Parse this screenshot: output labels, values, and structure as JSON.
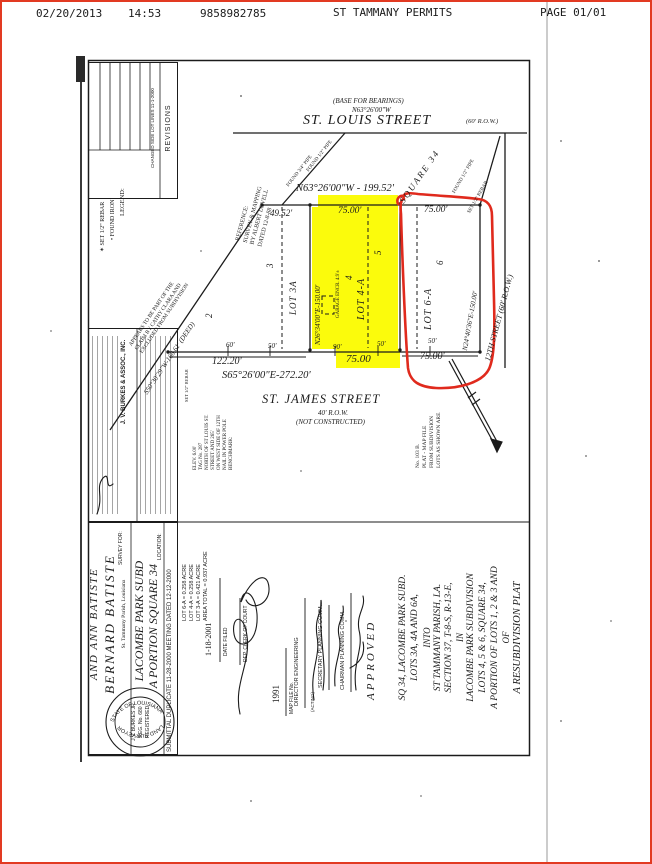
{
  "colors": {
    "highlight": "#fbfb0c",
    "annotation_red": "#e02a1d",
    "ink": "#1b1b1b",
    "page_border": "#e23a22"
  },
  "fax_header": {
    "date": "02/20/2013",
    "time": "14:53",
    "fax_number": "9858982785",
    "sender": "ST TAMMANY PERMITS",
    "page": "PAGE  01/01"
  },
  "revisions": {
    "title": "REVISIONS",
    "entry": "CHANGED SIDE LOT LINES 11-1-2000"
  },
  "legend": {
    "title": "LEGEND:",
    "item_found": "• FOUND IRON",
    "item_set": "✶ SET 1/2\" REBAR"
  },
  "firm": {
    "name": "J. V. BURKES & ASSOC., INC."
  },
  "map": {
    "bearing_note": "(BASE FOR BEARINGS)",
    "bearing_value": "N63°26'00\"W",
    "st_louis": "ST. LOUIS STREET",
    "st_louis_row": "(60' R.O.W.)",
    "square": "SQUARE 34",
    "north_line": "N63°26'00\"W - 199.52'",
    "reference": [
      "REFERENCE:",
      "SURVEY & MAPPING",
      "BY ALBERT LOVELL",
      "DATED 12-8-88"
    ],
    "claim": [
      "APPEARS TO BE PART OF THE",
      "CLAIM BY CATHY CLARA AND",
      "EXCLUDED FROM SUBDIVISION"
    ],
    "deed_line": "S50°30'29\"W-166.61' (DEED)",
    "monuments": {
      "m1": "FOUND 3/4\" PIPE",
      "m2": "FOUND 1/2\" PIPE",
      "m3": "FOUND 1/2\" PIPE",
      "m4": "SET 1/2\" REBAR",
      "m5": "SET 1/2\" REBAR"
    },
    "lots": {
      "lot3a": {
        "name": "LOT 3A",
        "old_a": "2",
        "old_b": "3",
        "top": "49.52'"
      },
      "lot4a": {
        "name": "LOT 4-A",
        "old_a": "4",
        "old_b": "5",
        "top": "75.00'",
        "bottom": "75.00",
        "west": "N26°34'00\"E-150.00'",
        "garage": "GARAGE ENCR. 4.9'±"
      },
      "lot6a": {
        "name": "LOT 6-A",
        "old_a": "6",
        "top": "75.00'",
        "bottom": "75.00'",
        "east": "N24°40'36\"E-150.00'",
        "tick": "50'"
      }
    },
    "twelfth_street": "12TH STREET (60' R.O.W.)",
    "ticks": {
      "t60": "60'",
      "t50a": "50'",
      "t90": "90'",
      "t50b": "50'"
    },
    "south_dims": {
      "d12220": "122.20'"
    },
    "south_line": "S65°26'00\"E-272.20'",
    "st_james": {
      "name": "ST. JAMES STREET",
      "row": "40' R.O.W.",
      "note": "(NOT CONSTRUCTED)"
    },
    "benchmark": [
      "BENCHMARK:",
      "NAIL IN POWER POLE",
      "ON WEST SIDE OF 12TH",
      "STREET AND 265'",
      "NORTH OF ST LOUIS ST.",
      "TAG No. 287",
      "ELEV. 6.00'"
    ],
    "plat_note": [
      "LOTS AS SHOWN ARE",
      "FROM SUBDIVISION",
      "PLAT - MAP FILE",
      "No. 103 B."
    ]
  },
  "title": {
    "lines": [
      "A RESUBDIVISION PLAT",
      "OF",
      "A PORTION OF LOTS 1, 2 & 3 AND",
      "LOTS 4, 5 & 6, SQUARE 34,",
      "LACOMBE PARK SUBDIVISION",
      "IN",
      "SECTION 37, T-8-S, R-13-E,",
      "ST TAMMANY PARISH, LA.",
      "INTO",
      "LOTS 3A, 4A AND 6A,",
      "SQ 34, LACOMBE PARK SUBD."
    ]
  },
  "left_block": {
    "submittal": "SUBMITTAL DUPLICATE 11-28-2000        MEETING DATED 12-12-2000",
    "area": [
      "AREA TOTAL = 0.937 ACRE",
      "LOT 3-A = 0.421 ACRE",
      "LOT 4-A = 0.258 ACRE",
      "LOT 6-A = 0.258 ACRE"
    ],
    "location_label": "LOCATION:",
    "location_1": "A PORTION SQUARE 34",
    "location_2": "LACOMBE PARK SUBD",
    "parish": "St. Tammany Parish, Louisiana",
    "survey_for": "SURVEY FOR:",
    "client_1": "BERNARD BATISTE",
    "client_2": "AND ANN BATISTE"
  },
  "seal": {
    "arc_top": "STATE OF LOUISIANA",
    "line1": "J.V. BURKES JR",
    "line2": "REG. No. 680",
    "line3": "REGISTERED",
    "arc_bottom": "LAND SURVEYOR"
  },
  "approval": {
    "approved": "APPROVED",
    "chairman": "CHAIRMAN PLANNING COMM.",
    "secretary": "SECRETARY PLANNING COMM.",
    "director": "DIRECTOR ENGINEERING",
    "acting": "(ACTING)",
    "clerk": "DEP. CLERK OF COURT",
    "date_filed_label": "DATE FILED",
    "date_filed": "1-18-2001",
    "map_file_label": "MAP FILE No.",
    "map_file": "1991"
  }
}
